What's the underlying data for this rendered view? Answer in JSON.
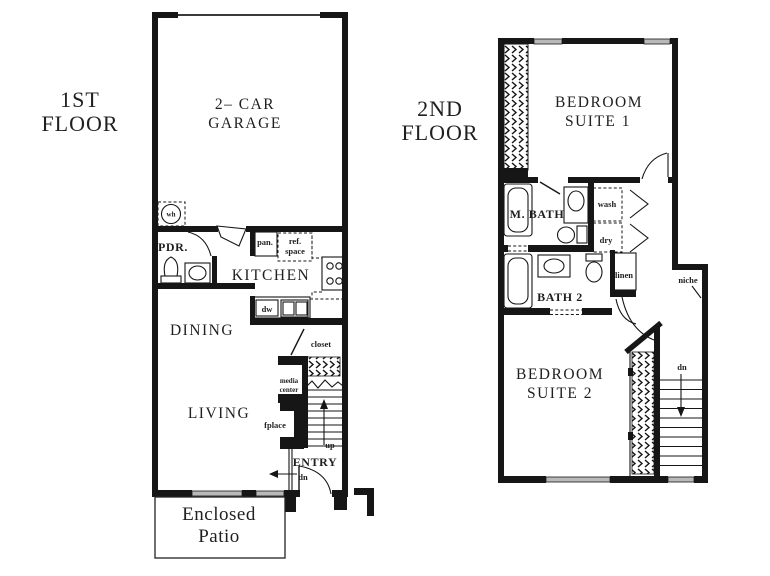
{
  "colors": {
    "wall": "#161616",
    "ink": "#1f1f1f",
    "bg": "#ffffff",
    "window": "#b9b9b9"
  },
  "first_floor": {
    "title": [
      "1ST",
      "FLOOR"
    ],
    "garage": [
      "2– CAR",
      "GARAGE"
    ],
    "kitchen": "KITCHEN",
    "dining": "DINING",
    "living": "LIVING",
    "entry": "ENTRY",
    "pdr": "PDR.",
    "patio": [
      "Enclosed",
      "Patio"
    ],
    "water_heater": "wh",
    "pantry": "pan.",
    "ref_space": [
      "ref.",
      "space"
    ],
    "dishwasher": "dw",
    "closet": "closet",
    "media_center": [
      "media",
      "center"
    ],
    "fireplace": "fplace",
    "up": "up",
    "down": "dn"
  },
  "second_floor": {
    "title": [
      "2ND",
      "FLOOR"
    ],
    "bedroom1": [
      "BEDROOM",
      "SUITE 1"
    ],
    "bedroom2": [
      "BEDROOM",
      "SUITE 2"
    ],
    "master_bath": "M. BATH",
    "bath2": "BATH 2",
    "wash": "wash",
    "dry": "dry",
    "linen": "linen",
    "niche": "niche",
    "down": "dn"
  }
}
